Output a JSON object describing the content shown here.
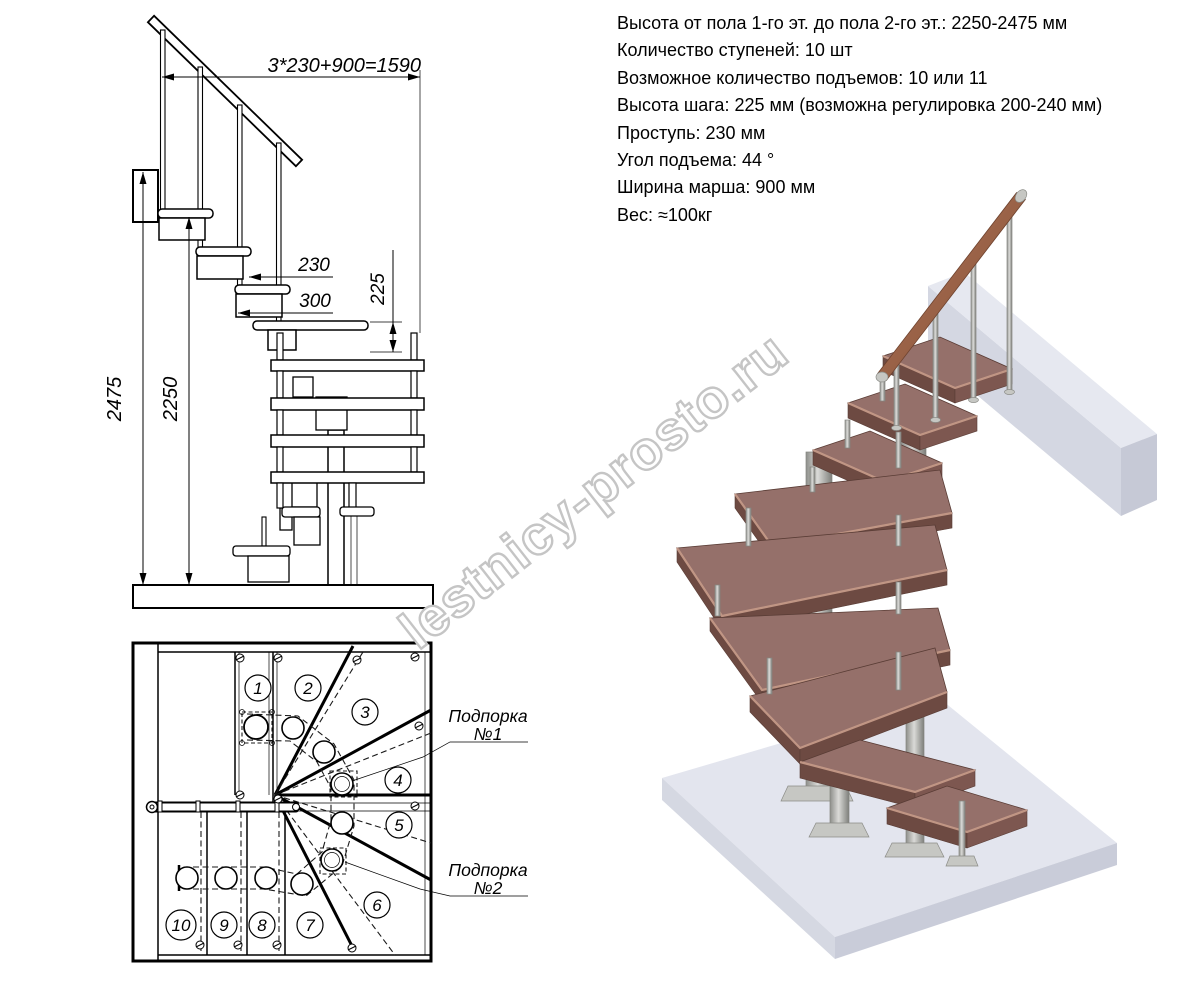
{
  "specs": {
    "lines": [
      "Высота от пола 1-го эт. до пола 2-го эт.: 2250-2475 мм",
      "Количество ступеней: 10 шт",
      "Возможное количество подъемов: 10 или 11",
      "Высота шага: 225 мм (возможна регулировка 200-240 мм)",
      "Проступь: 230 мм",
      "Угол подъема: 44 °",
      "Ширина марша: 900 мм",
      "Вес: ≈100кг"
    ]
  },
  "elevation": {
    "dims": {
      "total_run": "3*230+900=1590",
      "tread_depth": "230",
      "module_width": "300",
      "step_height": "225",
      "height_max": "2475",
      "height_min": "2250"
    }
  },
  "plan": {
    "steps": [
      "1",
      "2",
      "3",
      "4",
      "5",
      "6",
      "7",
      "8",
      "9",
      "10"
    ],
    "support1": {
      "line1": "Подпорка",
      "line2": "№1"
    },
    "support2": {
      "line1": "Подпорка",
      "line2": "№2"
    }
  },
  "watermark": "lestnicy-prosto.ru",
  "colors": {
    "wood_top": "#95706a",
    "wood_front": "#6d4a42",
    "wood_side": "#7d5750",
    "wood_nose": "#c59a88",
    "wood_edge": "#593c35",
    "handrail_wood": "#a2684c",
    "floor_top": "#e3e5ee",
    "floor_front": "#d5d8e2",
    "floor_side": "#c9ccd9",
    "beam_top": "#e6e8f0",
    "beam_front": "#d4d7e2",
    "beam_side": "#c6c9d6",
    "watermark_gray": "#c5c5c5"
  }
}
